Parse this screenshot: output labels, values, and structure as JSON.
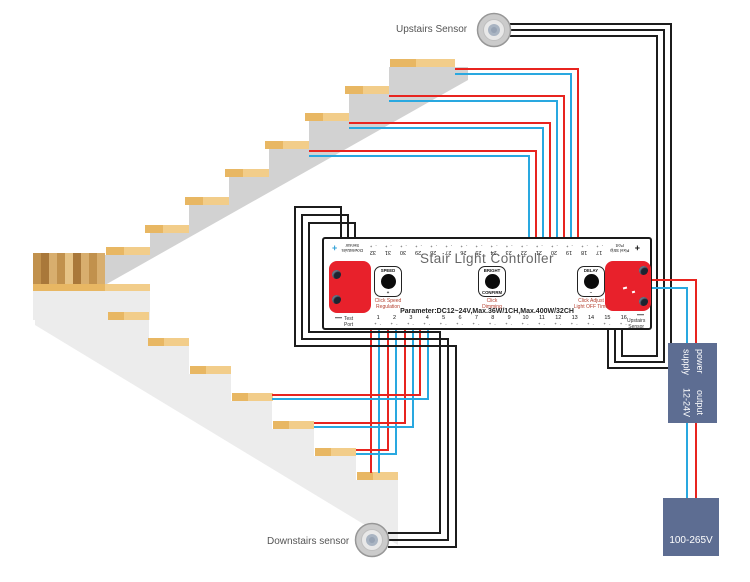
{
  "labels": {
    "upstairs_sensor": "Upstairs Sensor",
    "downstairs_sensor": "Downstairs sensor"
  },
  "controller": {
    "title": "Stair Light Controller",
    "parameter": "Parameter:DC12~24V,Max.36W/1CH,Max.400W/32CH",
    "plus": "+",
    "minus_mark": "—",
    "terminal_mark_top": "- +",
    "terminal_mark_bottom": "+ -",
    "downstairs_terminal_line1": "Downstairs",
    "downstairs_terminal_line2": "Sensor",
    "pixel_port_line1": "Pixel Strip",
    "pixel_port_line2": "Port",
    "top_terminals": [
      "32",
      "31",
      "30",
      "29",
      "28",
      "27",
      "26",
      "25",
      "24",
      "23",
      "22",
      "21",
      "20",
      "19",
      "18",
      "17"
    ],
    "bottom_terminals": [
      "1",
      "2",
      "3",
      "4",
      "5",
      "6",
      "7",
      "8",
      "9",
      "10",
      "11",
      "12",
      "13",
      "14",
      "15",
      "16"
    ],
    "test_port_line1": "Test",
    "test_port_line2": "Port",
    "upstairs_terminal_line1": "Upstairs",
    "upstairs_terminal_line2": "Sensor",
    "knobs": [
      {
        "title": "SPEED",
        "sub": "+",
        "cap1": "Click Speed",
        "cap2": "Regulation"
      },
      {
        "title": "BRIGHT",
        "sub": "CONFIRM",
        "cap1": "Click",
        "cap2": "Dimming"
      },
      {
        "title": "DELAY",
        "sub": "–",
        "cap1": "Click Adjust",
        "cap2": "Light OFF Time"
      }
    ]
  },
  "power": {
    "supply_line1": "power supply",
    "supply_line2": "output 12-24V",
    "input_label": "100-265V"
  },
  "colors": {
    "wire_red": "#e8241f",
    "wire_blue": "#29a8e0",
    "wire_black": "#1c1c1c",
    "block_red": "#e8212b",
    "box_slate": "#5d6d92",
    "stair_upper": "#d2d2d2",
    "stair_lower": "#ececec",
    "step_light": "#f2cd8a",
    "step_light_dark": "#e8b763",
    "wood_1": "#c1914d",
    "wood_2": "#a9783a",
    "wood_3": "#d8ae6e",
    "wood_4": "#e6c386",
    "plus_blue": "#2d9fd6",
    "caption_red": "#b5402f",
    "title_gray": "#666666"
  }
}
